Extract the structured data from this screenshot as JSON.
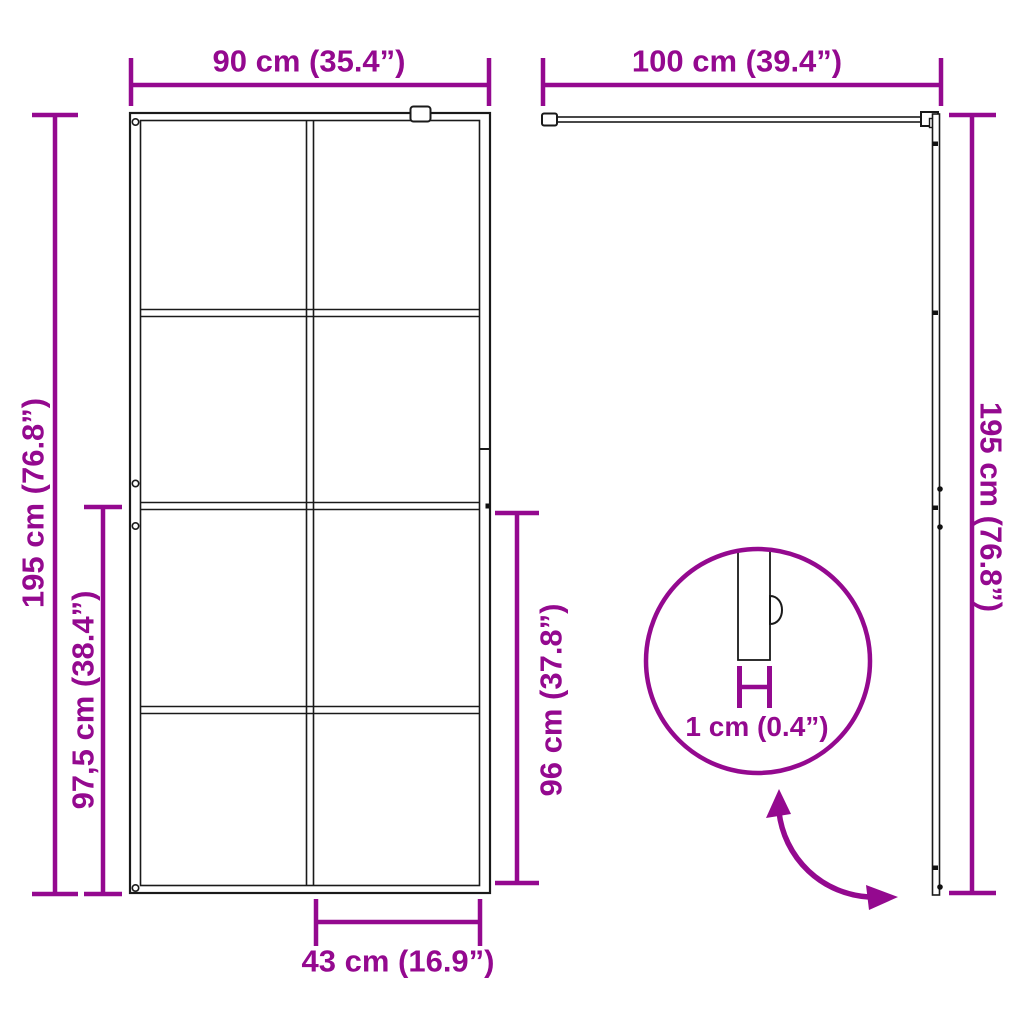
{
  "colors": {
    "accent": "#94098F",
    "line": "#1A1A1A",
    "background": "#FFFFFF"
  },
  "diagram": {
    "front_view": {
      "width_label": "90 cm (35.4”)",
      "height_label": "195 cm (76.8”)",
      "lower_section_height_label": "97,5 cm (38.4”)",
      "glass_panel_height_label": "96 cm (37.8”)",
      "bottom_panel_width_label": "43 cm (16.9”)"
    },
    "side_view": {
      "support_arm_length_label": "100 cm (39.4”)",
      "height_label": "195 cm (76.8”)"
    },
    "thickness_detail": {
      "glass_thickness_label": "1 cm (0.4”)"
    }
  }
}
